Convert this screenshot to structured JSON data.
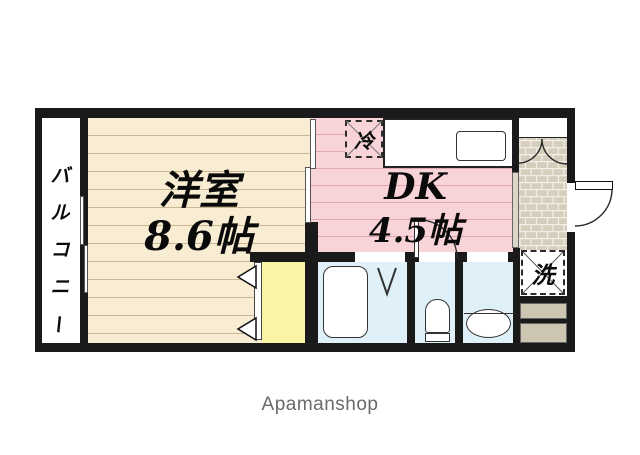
{
  "brand": {
    "name": "Apamanshop"
  },
  "floorplan": {
    "balcony": {
      "label": "バルコニー",
      "chars": [
        "バ",
        "ル",
        "コ",
        "ニ",
        "ー"
      ]
    },
    "western_room": {
      "name": "洋室",
      "size": "8.6帖"
    },
    "dining_kitchen": {
      "name": "DK",
      "size": "4.5帖"
    },
    "refrigerator": {
      "label": "冷"
    },
    "washing_machine": {
      "label": "洗"
    }
  },
  "colors": {
    "wall": "#1a1a1a",
    "wood_floor": "#F8EDD2",
    "wood_line": "#C9B794",
    "dk_floor": "#F8D3D8",
    "dk_line": "#E0A9B2",
    "closet": "#FAF5A5",
    "wet_room": "#DFF0F8",
    "entrance_tile": "#D6CEBC",
    "tile_joint": "#F2EFE6",
    "step": "#CCC5B2",
    "brand_text": "#6A6A6A"
  }
}
